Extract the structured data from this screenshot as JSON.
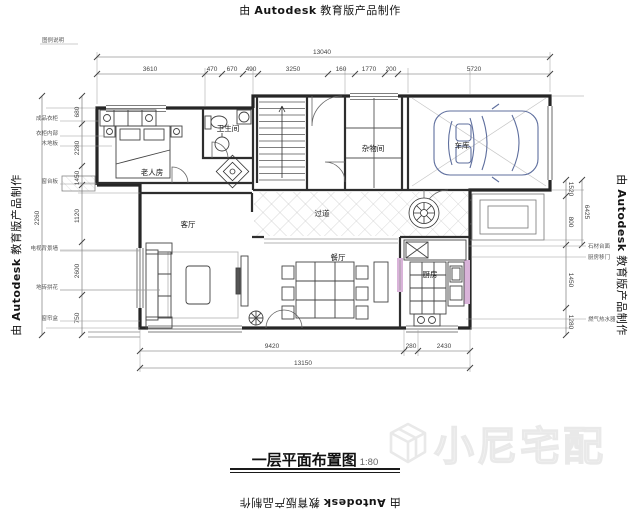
{
  "watermarks": {
    "autodesk": {
      "prefix": "由",
      "name": "Autodesk",
      "suffix": "教育版产品制作"
    },
    "brand": "小尼宅配"
  },
  "title": {
    "text": "一层平面布置图",
    "scale": "1:80"
  },
  "rooms": {
    "bedroom": "老人房",
    "bathroom": "卫生间",
    "storage": "杂物间",
    "garage": "车库",
    "hallway": "过道",
    "living": "客厅",
    "dining": "餐厅",
    "kitchen": "厨房"
  },
  "dims": {
    "top_total": "13040",
    "top_segments": [
      "3610",
      "470",
      "670",
      "490",
      "3250",
      "160",
      "1770",
      "200",
      "5720"
    ],
    "bottom_segments": [
      "9420",
      "280",
      "2430"
    ],
    "bottom_total": "13150",
    "left_inner": [
      "680",
      "2280",
      "1450",
      "1120",
      "2600",
      "750"
    ],
    "left_outer": "2260",
    "right_inner": [
      "1520",
      "800",
      "1450",
      "1280"
    ],
    "right_outer": "6425"
  },
  "annotations": {
    "top_left": "图例说明",
    "left": [
      "成品衣柜",
      "衣柜内部",
      "木地板",
      "窗台板",
      "电视背景墙",
      "地砖拼花",
      "窗帘盒"
    ],
    "right": [
      "石材台面",
      "厨房移门",
      "燃气热水器"
    ]
  }
}
